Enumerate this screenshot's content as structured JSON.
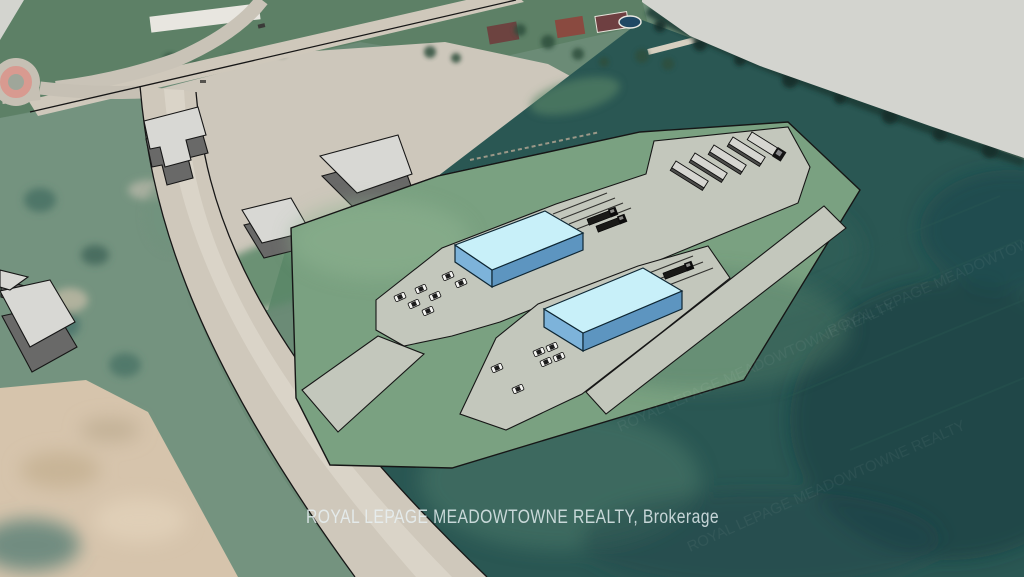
{
  "branding": {
    "watermark": "ROYAL LEPAGE MEADOWTOWNE REALTY, Brokerage",
    "watermark_echo": "ROYAL LEPAGE MEADOWTOWNE REALTY"
  },
  "scene": {
    "view": "aerial-3d-site-plan-rendering",
    "proposed_building_count": 2,
    "existing_building_count": 5,
    "parked_trailer_count": 5,
    "dock_truck_count": 3,
    "parked_car_count": 13
  },
  "colors": {
    "sky": "#d3d4cf",
    "photo_base": "#6b8b76",
    "grass": "#5d8066",
    "gravel": "#cdc7bb",
    "dirt": "#d6c4ac",
    "field_teal": "#2a5753",
    "site_green": "#7aa181",
    "pavement": "#c3c7bc",
    "road": "#cfc8bb",
    "road_stripe": "#ded8cc",
    "outline": "#161616",
    "proposed_roof": "#c8f0f9",
    "proposed_side_light": "#7db3da",
    "proposed_side_dark": "#5d95c0",
    "existing_roof": "#d8d8d4",
    "existing_side": "#696968",
    "trailer_top": "#d6d6d1",
    "vehicle_dark": "#191917",
    "car_body": "#f4f4f1",
    "roundabout_ring": "#d89a90",
    "watermark_color": "#e8f2f5"
  }
}
